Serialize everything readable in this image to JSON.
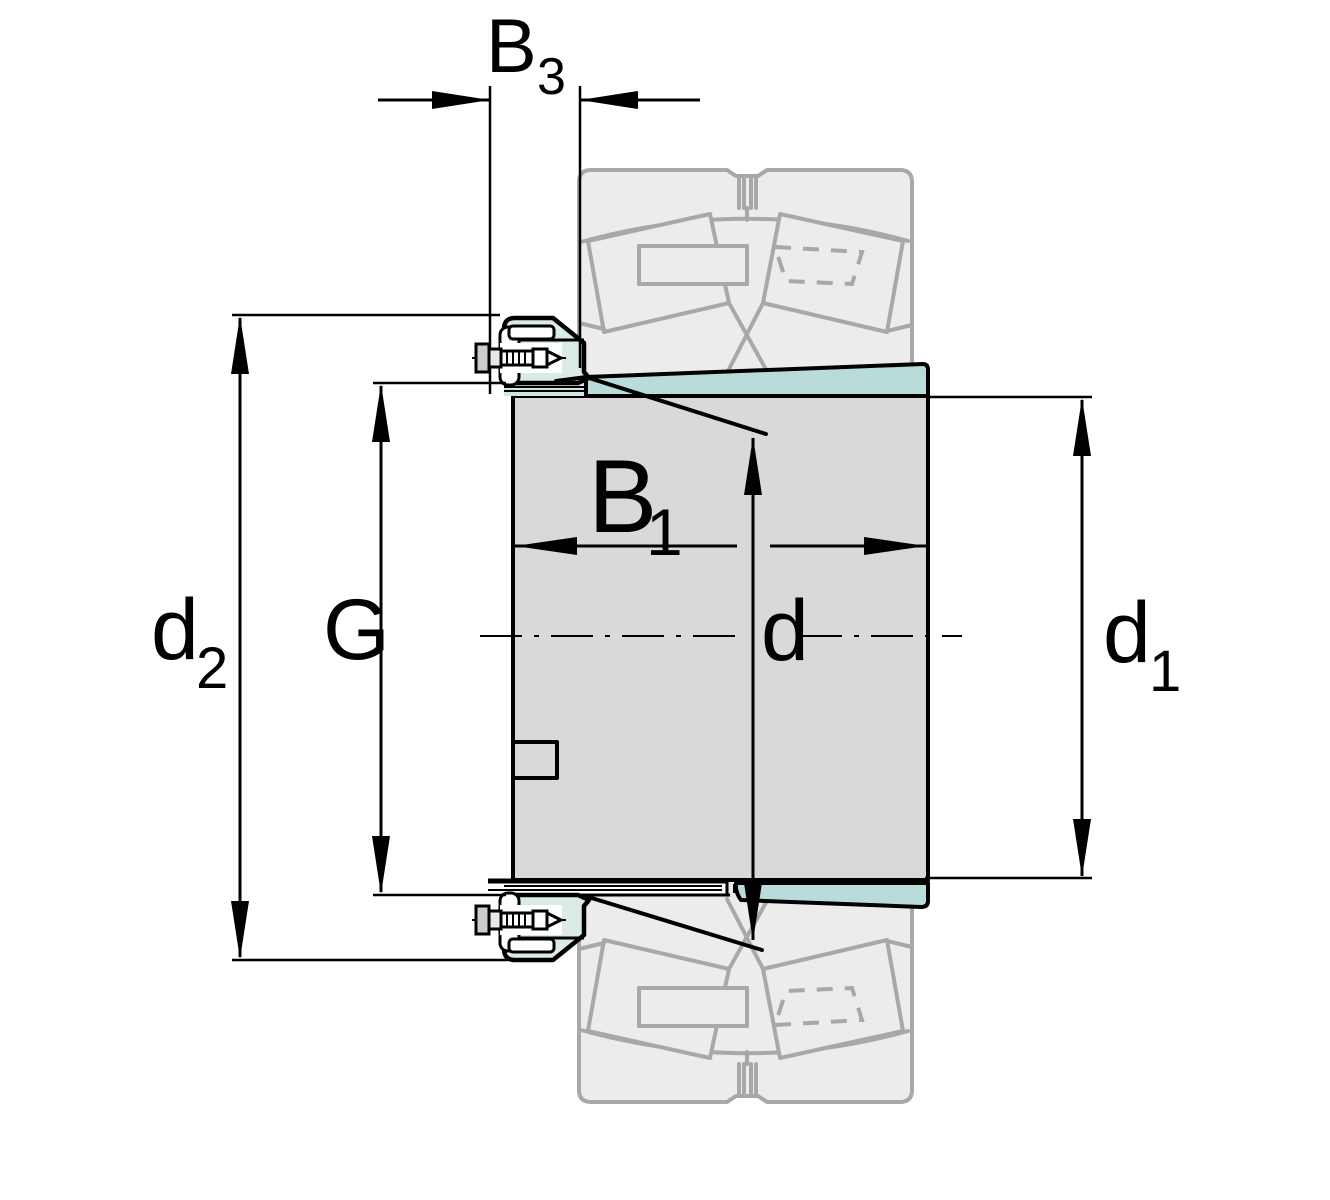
{
  "diagram": {
    "title": "adapter-sleeve-with-locknut-section-drawing",
    "labels": {
      "b3": {
        "base": "B",
        "sub": "3"
      },
      "d2": {
        "base": "d",
        "sub": "2"
      },
      "g": {
        "base": "G"
      },
      "b1": {
        "base": "B",
        "sub": "1"
      },
      "d": {
        "base": "d"
      },
      "d1": {
        "base": "d",
        "sub": "1"
      }
    },
    "colors": {
      "line": "#000000",
      "sleeve_teal": "#b9dcda",
      "nut_teal": "#daeae5",
      "thread_band_teal": "#cfe6e2",
      "body_gray": "#d9d9d9",
      "ghost_fill": "#ececec",
      "ghost_stroke": "#a8a8a8",
      "background": "#ffffff"
    }
  }
}
